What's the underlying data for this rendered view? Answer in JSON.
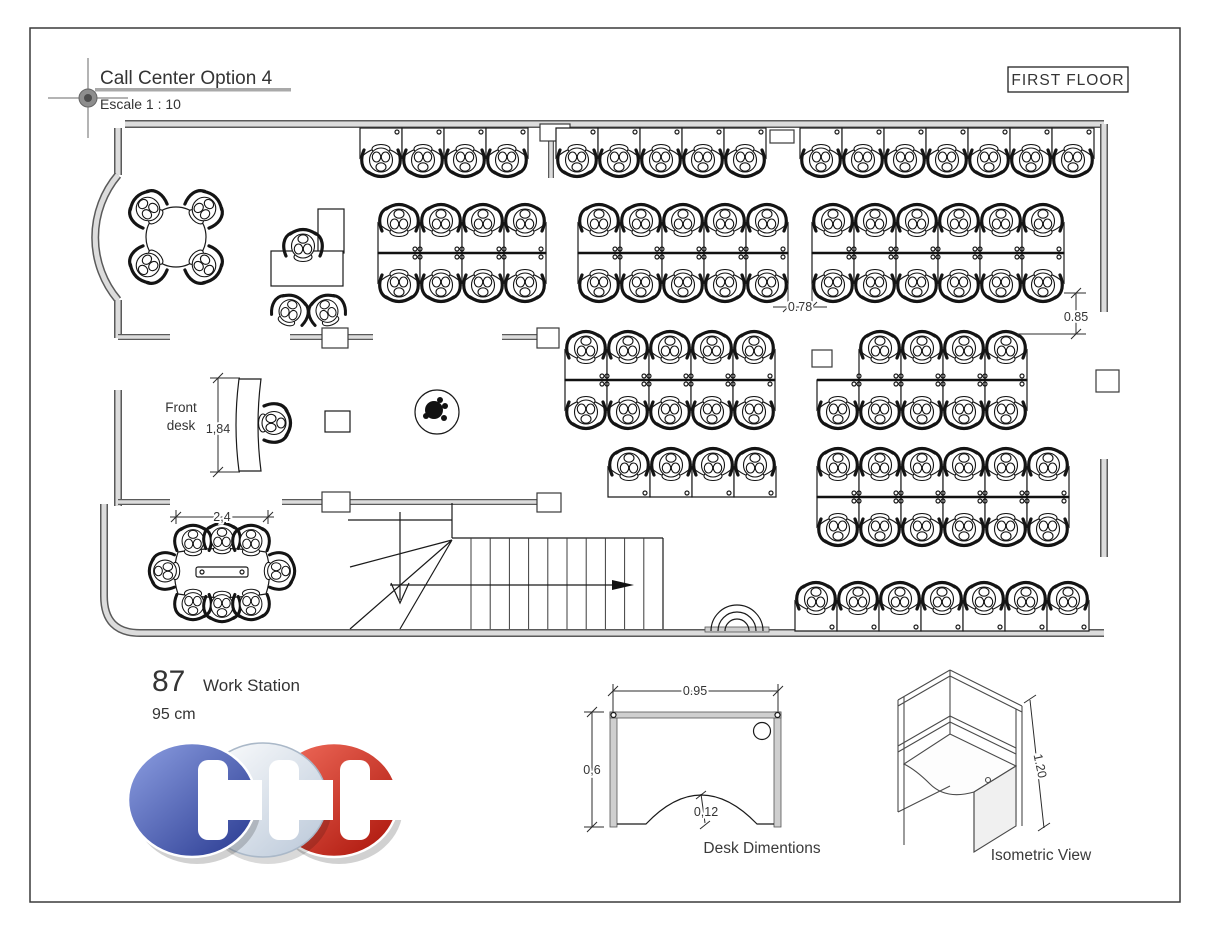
{
  "title_block": {
    "title": "Call Center Option 4",
    "scale": "Escale 1 : 10"
  },
  "floor_tag": "FIRST FLOOR",
  "plan": {
    "front_desk_line1": "Front",
    "front_desk_line2": "desk",
    "dim_front_desk": "1,84",
    "dim_conference": "2,4",
    "dim_aisle": "0.78",
    "dim_right_gap": "0.85"
  },
  "summary": {
    "count": "87",
    "count_label": "Work Station",
    "unit": "95 cm"
  },
  "desk_detail": {
    "dim_width": "0.95",
    "dim_depth": "0,6",
    "dim_cutout": "0,12",
    "caption": "Desk Dimentions"
  },
  "isometric": {
    "dim_height": "1.20",
    "caption": "Isometric View"
  },
  "logo": {
    "letters": "CCC",
    "colors": {
      "blue": "#3b4fae",
      "silver": "#dde6f0",
      "red": "#cf2318"
    }
  }
}
